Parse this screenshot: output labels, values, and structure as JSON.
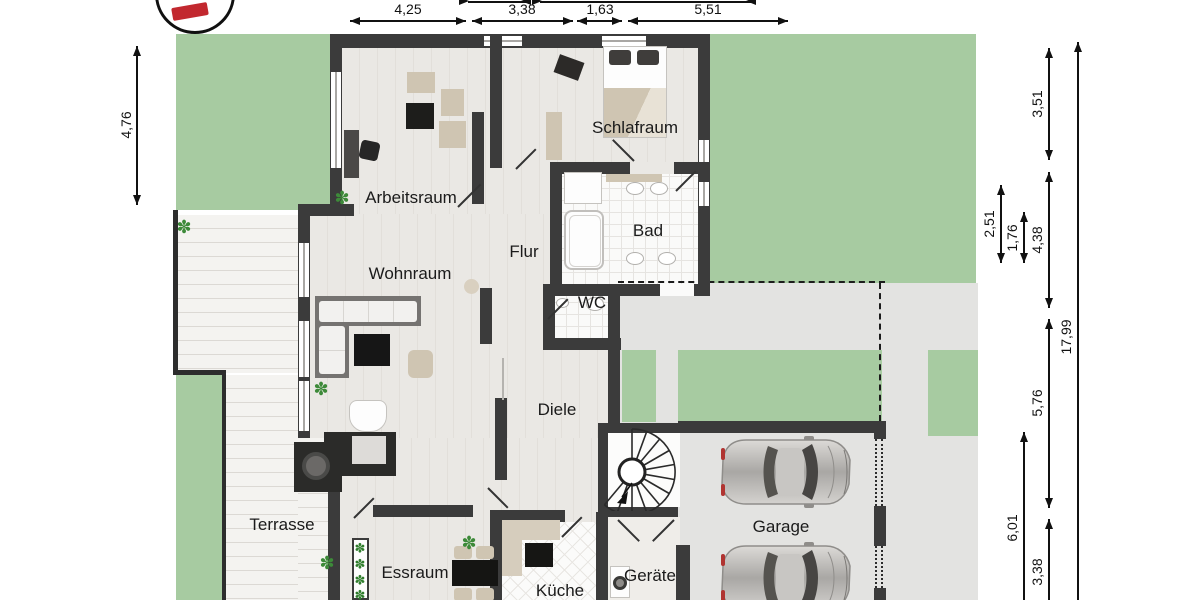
{
  "rooms": [
    {
      "id": "arbeitsraum",
      "label": "Arbeitsraum"
    },
    {
      "id": "schlafraum",
      "label": "Schlafraum"
    },
    {
      "id": "bad",
      "label": "Bad"
    },
    {
      "id": "flur",
      "label": "Flur"
    },
    {
      "id": "wc",
      "label": "WC"
    },
    {
      "id": "wohnraum",
      "label": "Wohnraum"
    },
    {
      "id": "diele",
      "label": "Diele"
    },
    {
      "id": "terrasse",
      "label": "Terrasse"
    },
    {
      "id": "essraum",
      "label": "Essraum"
    },
    {
      "id": "kueche",
      "label": "Küche"
    },
    {
      "id": "geraete",
      "label": "Geräte"
    },
    {
      "id": "garage",
      "label": "Garage"
    }
  ],
  "dimensions": {
    "top": [
      "4,25",
      "3,38",
      "1,63",
      "5,51"
    ],
    "left": [
      "4,76"
    ],
    "right": [
      "3,51",
      "2,51",
      "1,76",
      "4,38",
      "17,99",
      "5,76",
      "6,01",
      "3,38"
    ]
  },
  "glyphs": {
    "plant": "✽"
  },
  "colors": {
    "lawn": "#a7cba1",
    "driveway": "#e3e3e1",
    "wall": "#3b3b3b",
    "deck": "#f3f2ef",
    "floor": "#e9e7e3",
    "dimension": "#111111",
    "logo_red": "#c2282f",
    "plant_green": "#3d8a39"
  }
}
